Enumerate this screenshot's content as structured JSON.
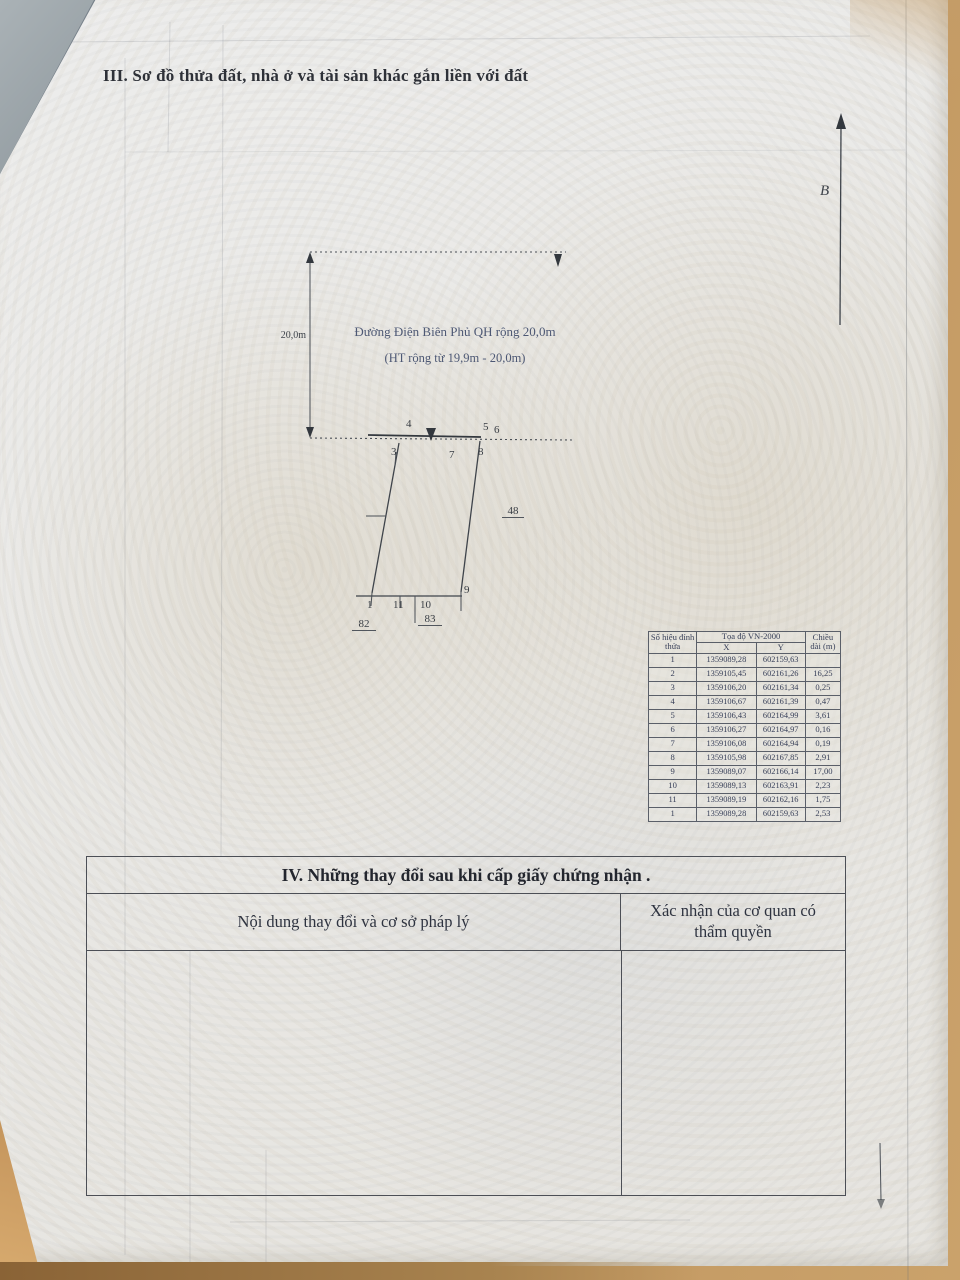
{
  "page": {
    "section3_title": "III. Sơ đồ thửa đất, nhà ở và tài sản khác gắn liền với đất",
    "north_label": "B"
  },
  "diagram": {
    "road_name": "Đường Điện Biên Phủ QH rộng 20,0m",
    "road_note": "(HT rộng từ 19,9m - 20,0m)",
    "road_width_label": "20,0m",
    "vertex_labels": [
      "4",
      "5",
      "6",
      "3",
      "7",
      "8",
      "1",
      "11",
      "10",
      "9"
    ],
    "adjacent_plots": [
      "82",
      "83",
      "48"
    ]
  },
  "coord_table": {
    "col1_header": "Số hiệu đỉnh thửa",
    "group_header": "Tọa độ VN-2000",
    "x_header": "X",
    "y_header": "Y",
    "length_header": "Chiều dài (m)",
    "rows": [
      {
        "id": "1",
        "x": "1359089,28",
        "y": "602159,63",
        "len": ""
      },
      {
        "id": "2",
        "x": "1359105,45",
        "y": "602161,26",
        "len": "16,25"
      },
      {
        "id": "3",
        "x": "1359106,20",
        "y": "602161,34",
        "len": "0,25"
      },
      {
        "id": "4",
        "x": "1359106,67",
        "y": "602161,39",
        "len": "0,47"
      },
      {
        "id": "5",
        "x": "1359106,43",
        "y": "602164,99",
        "len": "3,61"
      },
      {
        "id": "6",
        "x": "1359106,27",
        "y": "602164,97",
        "len": "0,16"
      },
      {
        "id": "7",
        "x": "1359106,08",
        "y": "602164,94",
        "len": "0,19"
      },
      {
        "id": "8",
        "x": "1359105,98",
        "y": "602167,85",
        "len": "2,91"
      },
      {
        "id": "9",
        "x": "1359089,07",
        "y": "602166,14",
        "len": "17,00"
      },
      {
        "id": "10",
        "x": "1359089,13",
        "y": "602163,91",
        "len": "2,23"
      },
      {
        "id": "11",
        "x": "1359089,19",
        "y": "602162,16",
        "len": "1,75"
      },
      {
        "id": "1",
        "x": "1359089,28",
        "y": "602159,63",
        "len": "2,53"
      }
    ]
  },
  "section4": {
    "title": "IV. Những thay đổi sau khi cấp giấy chứng nhận .",
    "left_header": "Nội dung thay đổi và cơ sở pháp lý",
    "right_header": "Xác nhận của cơ quan có thẩm quyền"
  }
}
